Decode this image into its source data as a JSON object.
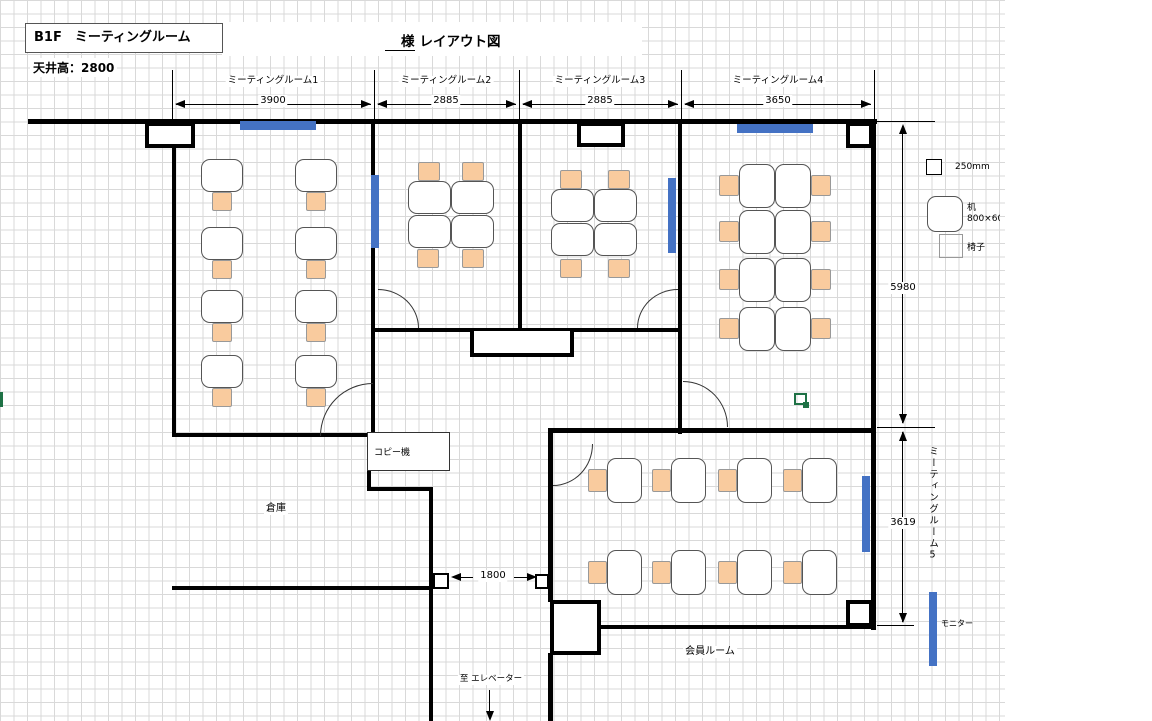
{
  "title": {
    "header": "B1F　ミーティングルーム",
    "client_prefix": "様",
    "layout": "レイアウト図",
    "ceiling": "天井高：2800"
  },
  "floorplan": {
    "rooms": [
      {
        "name": "ミーティングルーム1",
        "width_mm": "3900",
        "desks": 8,
        "chairs": 8,
        "monitor_wall": "top"
      },
      {
        "name": "ミーティングルーム2",
        "width_mm": "2885",
        "desks": 4,
        "chairs": 4,
        "monitor_wall": "left"
      },
      {
        "name": "ミーティングルーム3",
        "width_mm": "2885",
        "desks": 4,
        "chairs": 4,
        "monitor_wall": "right"
      },
      {
        "name": "ミーティングルーム4",
        "width_mm": "3650",
        "desks": 8,
        "chairs": 8,
        "monitor_wall": "top"
      },
      {
        "name": "ミーティングルーム5",
        "desks": 8,
        "chairs": 8,
        "monitor_wall": "right"
      }
    ],
    "dimensions": {
      "right_upper": "5980",
      "right_lower": "3619",
      "door_opening": "1800"
    },
    "labels": {
      "copier": "コピー機",
      "storage": "倉庫",
      "member_room": "会員ルーム",
      "elevator": "至 エレベーター",
      "monitor": "モニター"
    }
  },
  "legend": {
    "grid_label": "250mm",
    "desk_label": "机",
    "desk_size": "800×600",
    "chair_label": "椅子"
  },
  "colors": {
    "chair_fill": "#F9CB9E",
    "monitor_blue": "#4472C4",
    "green_accent": "#1E7145",
    "wall": "#000000",
    "grid_line": "#d9d9d9"
  }
}
